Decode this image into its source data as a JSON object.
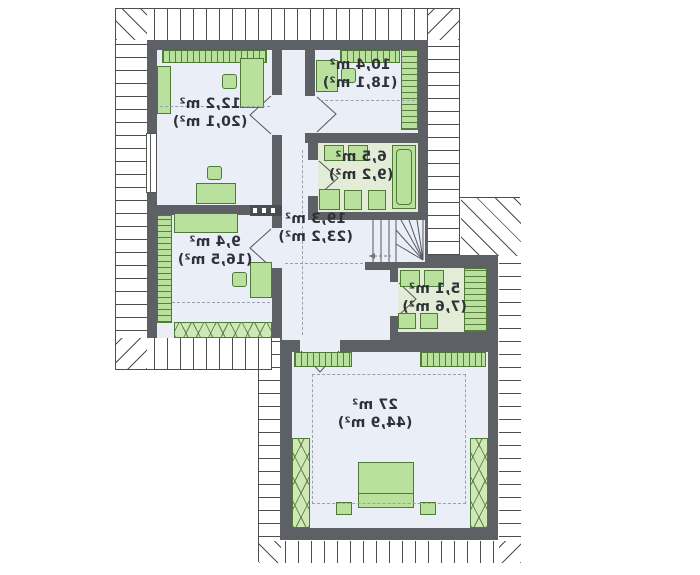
{
  "plan": {
    "type": "attic-floor-plan-mirrored",
    "rooms": [
      {
        "name": "room-12-2",
        "area": "12,2 m²",
        "area_with_sloped": "(20,1 m²)"
      },
      {
        "name": "room-10-4",
        "area": "10,4 m²",
        "area_with_sloped": "(18,1 m²)"
      },
      {
        "name": "room-6-5",
        "area": "6,5 m²",
        "area_with_sloped": "(9,2 m²)"
      },
      {
        "name": "hall-19-3",
        "area": "19,3 m²",
        "area_with_sloped": "(23,2 m²)"
      },
      {
        "name": "room-9-4",
        "area": "9,4 m²",
        "area_with_sloped": "(16,5 m²)"
      },
      {
        "name": "room-5-1",
        "area": "5,1 m²",
        "area_with_sloped": "(7,6 m²)"
      },
      {
        "name": "room-27",
        "area": "27 m²",
        "area_with_sloped": "(44,9 m²)"
      }
    ],
    "colors": {
      "wall": "#5d6064",
      "floor": "#eaeef6",
      "wet_floor": "#e2ecd6",
      "furniture_fill": "#b9e09c",
      "furniture_border": "#4e7a38",
      "roof_line": "#4e4e4e"
    },
    "text_mirrored": true
  }
}
